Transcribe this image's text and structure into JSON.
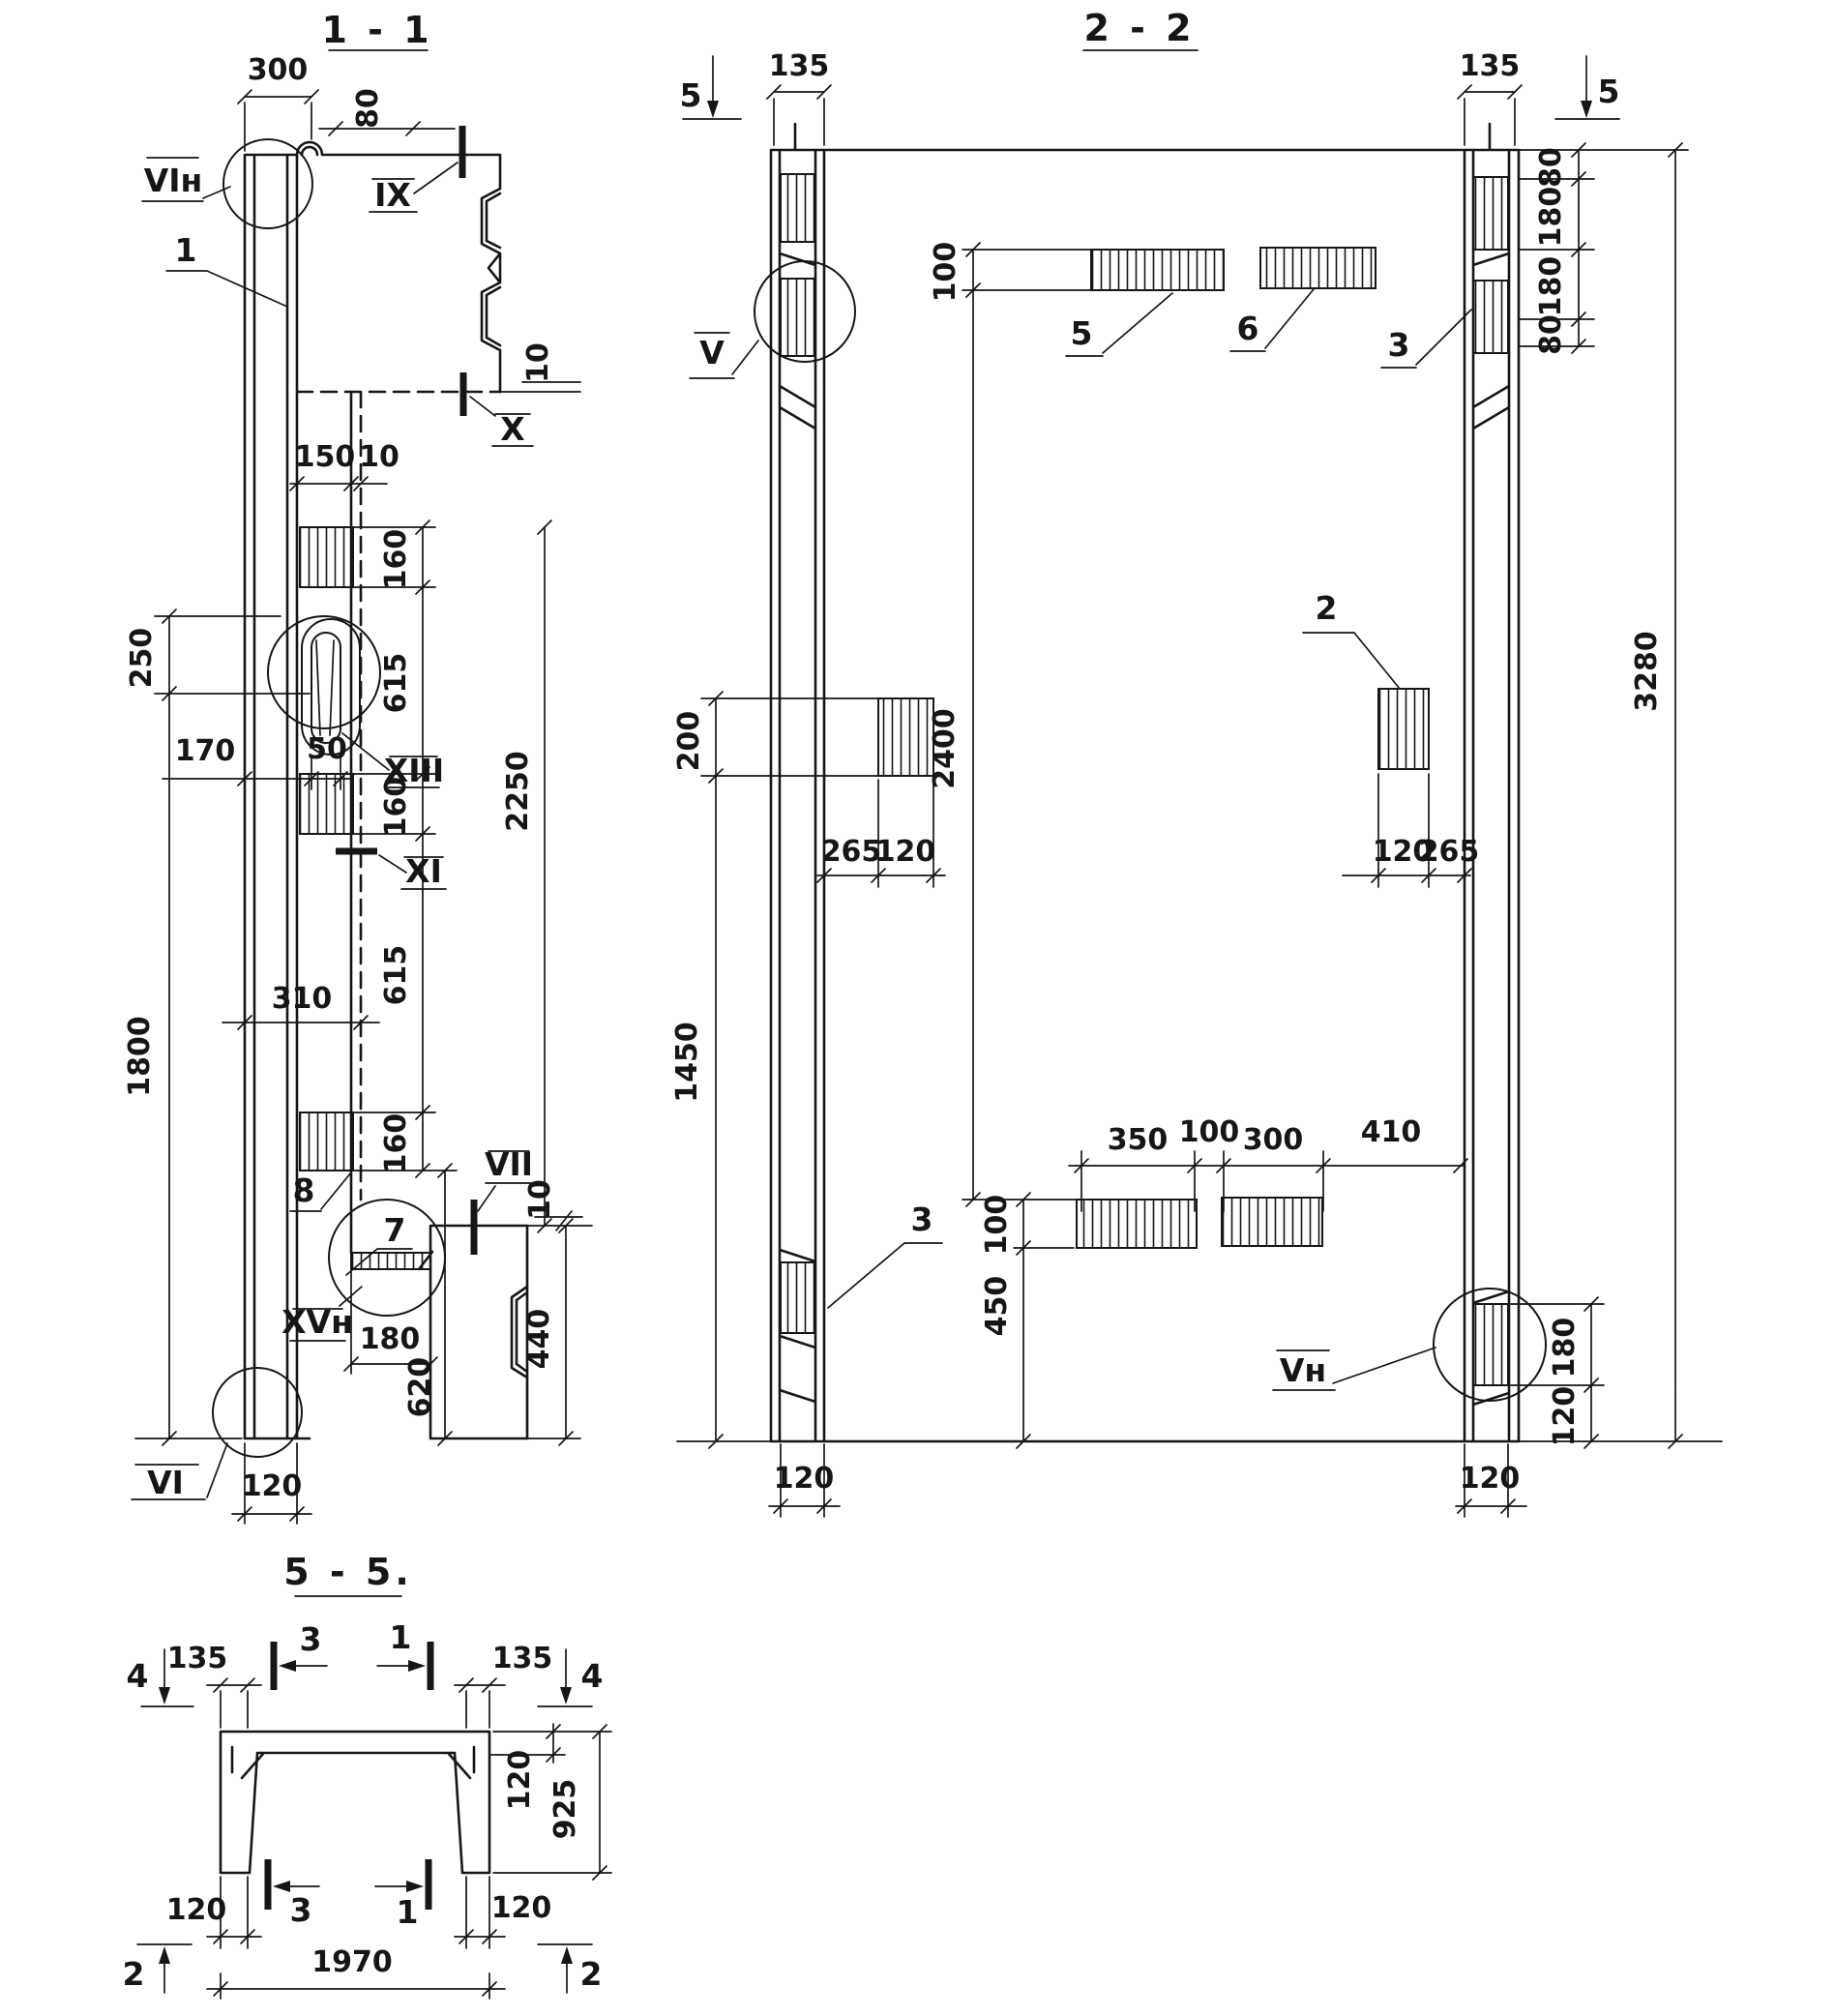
{
  "s11": {
    "title": "1 - 1",
    "d300": "300",
    "d80": "80",
    "mIX": "IX",
    "mX": "X",
    "d10a": "10",
    "lVIh": "VIн",
    "l1": "1",
    "d150": "150",
    "d10b": "10",
    "d250": "250",
    "d170": "170",
    "d50": "50",
    "mXIII": "XIII",
    "d160a": "160",
    "d615a": "615",
    "d160b": "160",
    "mXI": "XI",
    "d615b": "615",
    "d160c": "160",
    "d310": "310",
    "d1800": "1800",
    "d2250": "2250",
    "l8": "8",
    "l7": "7",
    "mVII": "VII",
    "d10c": "10",
    "mXVh": "XVн",
    "d180": "180",
    "d620": "620",
    "d440": "440",
    "lVI": "VI",
    "d120": "120"
  },
  "s22": {
    "title": "2 - 2",
    "m5L": "5",
    "d135L": "135",
    "d135R": "135",
    "m5R": "5",
    "d80a": "80",
    "d180a": "180",
    "d180b": "180",
    "d80b": "80",
    "d3280": "3280",
    "d100t": "100",
    "d2400": "2400",
    "l5": "5",
    "l6": "6",
    "l3R": "3",
    "mV": "V",
    "d200": "200",
    "d1450": "1450",
    "l2": "2",
    "d265L": "265",
    "d120L": "120",
    "d120R": "120",
    "d265R": "265",
    "d350": "350",
    "d100m": "100",
    "d300": "300",
    "d410": "410",
    "d100b": "100",
    "d450": "450",
    "l3L": "3",
    "mVh": "Vн",
    "d180R": "180",
    "d120Rc": "120",
    "d120bL": "120",
    "d120bR": "120"
  },
  "s55": {
    "title": "5 - 5.",
    "m4L": "4",
    "d135L": "135",
    "m3t": "3",
    "m1t": "1",
    "d135R": "135",
    "m4R": "4",
    "d120t": "120",
    "d925": "925",
    "d120bl": "120",
    "m3b": "3",
    "m1b": "1",
    "d120br": "120",
    "d1970": "1970",
    "m2L": "2",
    "m2R": "2"
  }
}
